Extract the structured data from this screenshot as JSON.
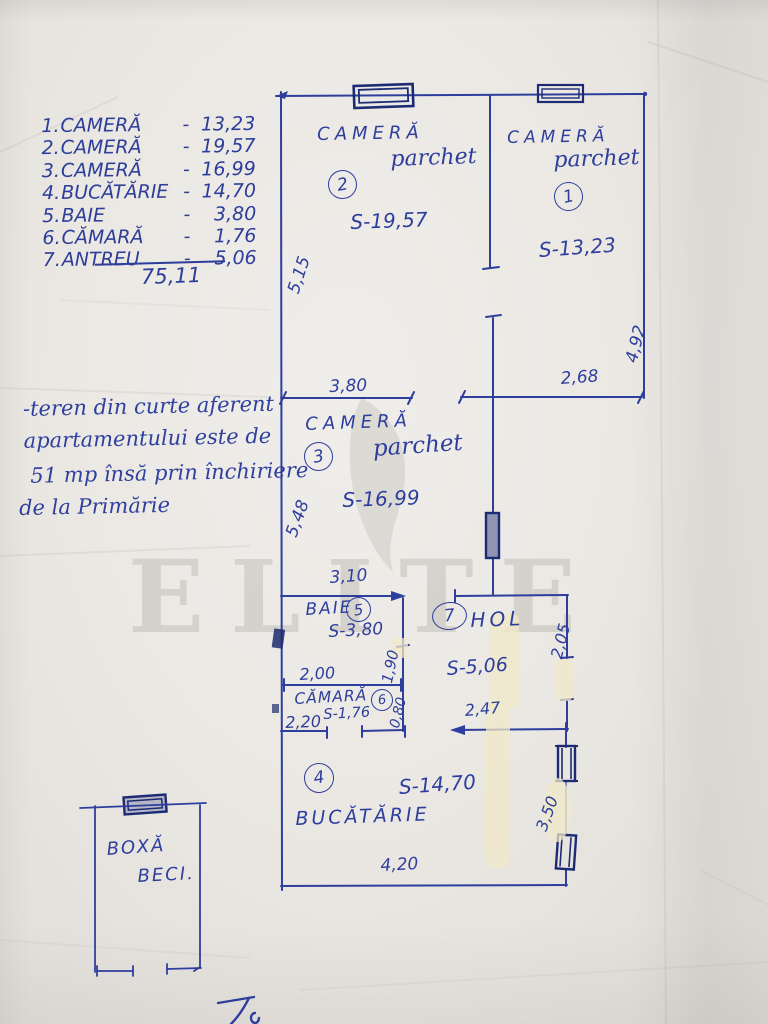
{
  "paper": {
    "watermark": "ELITE"
  },
  "summary": {
    "rows": [
      {
        "no": "1.",
        "name": "CAMERĂ",
        "dash": "-",
        "value": "13,23"
      },
      {
        "no": "2.",
        "name": "CAMERĂ",
        "dash": "-",
        "value": "19,57"
      },
      {
        "no": "3.",
        "name": "CAMERĂ",
        "dash": "-",
        "value": "16,99"
      },
      {
        "no": "4.",
        "name": "BUCĂTĂRIE",
        "dash": "-",
        "value": "14,70"
      },
      {
        "no": "5.",
        "name": "BAIE",
        "dash": "-",
        "value": "3,80"
      },
      {
        "no": "6.",
        "name": "CĂMARĂ",
        "dash": "-",
        "value": "1,76"
      },
      {
        "no": "7.",
        "name": "ANTREU",
        "dash": "-",
        "value": "5,06"
      }
    ],
    "total": "75,11"
  },
  "note": {
    "l1": "-teren din curte aferent",
    "l2": "apartamentului este de",
    "l3": "51 mp însă prin închiriere",
    "l4": "de la Primărie"
  },
  "plan": {
    "room2": {
      "name": "CAMERĂ",
      "floor": "parchet",
      "number": "2",
      "area": "S-19,57"
    },
    "room1": {
      "name": "CAMERĂ",
      "floor": "parchet",
      "number": "1",
      "area": "S-13,23"
    },
    "room3": {
      "name": "CAMERĂ",
      "floor": "parchet",
      "number": "3",
      "area": "S-16,99"
    },
    "baie": {
      "name": "BAIE",
      "number": "5",
      "area": "S-3,80"
    },
    "hol": {
      "name": "HOL",
      "number": "7",
      "area": "S-5,06"
    },
    "camara": {
      "name": "CĂMARĂ",
      "number": "6",
      "area": "S-1,76"
    },
    "bucatarie": {
      "name": "BUCĂTĂRIE",
      "number": "4",
      "area": "S-14,70"
    },
    "boxa": {
      "line1": "BOXĂ",
      "line2": "BECI."
    },
    "dims": {
      "d515": "5,15",
      "d380": "3,80",
      "d268": "2,68",
      "d492": "4,92",
      "d548": "5,48",
      "d310": "3,10",
      "d200": "2,00",
      "d190": "1,90",
      "d080": "0,80",
      "d220": "2,20",
      "d247": "2,47",
      "d205": "2,05",
      "d350": "3,50",
      "d420": "4,20"
    }
  },
  "signature_mark": "7."
}
